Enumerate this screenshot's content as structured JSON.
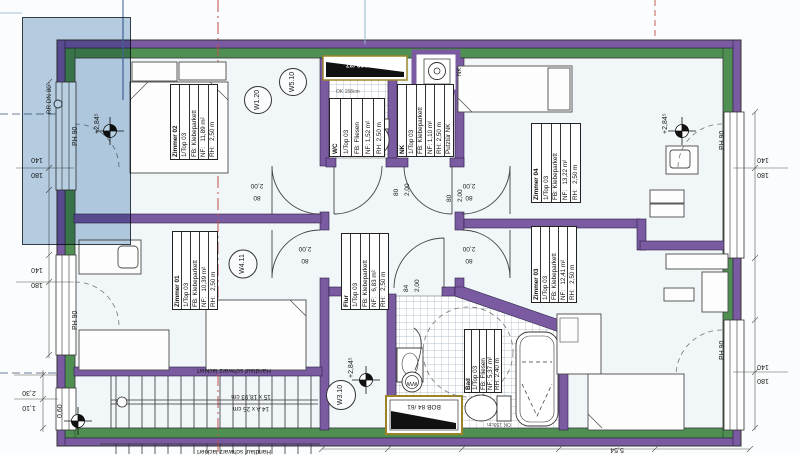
{
  "rooms": {
    "zimmer02": {
      "name": "Zimmer 02",
      "rows": [
        "1/Top 03",
        "FB: Klebeparkett",
        "NF:   11,89 m²",
        "RH:   2,50 m"
      ]
    },
    "zimmer01": {
      "name": "Zimmer 01",
      "rows": [
        "1/Top 03",
        "FB: Klebeparkett",
        "NF:   10,39 m²",
        "RH:   2,50 m"
      ]
    },
    "zimmer04": {
      "name": "Zimmer 04",
      "rows": [
        "1/Top 03",
        "FB: Klebeparkett",
        "NF:   13,22 m²",
        "RH:   2,50 m"
      ]
    },
    "zimmer03": {
      "name": "Zimmer 03",
      "rows": [
        "1/Top 03",
        "FB: Klebeparkett",
        "NF:   12,41 m²",
        "RH:   2,50 m"
      ]
    },
    "flur": {
      "name": "Flur",
      "rows": [
        "1/Top 03",
        "FB: Klebeparkett",
        "NF:   6,83 m²",
        "RH:   2,50 m"
      ]
    },
    "wc": {
      "name": "WC",
      "rows": [
        "1/Top 03",
        "FB: Fliesen",
        "NF: 1,52 m²",
        "RH: 2,50 m"
      ]
    },
    "nk": {
      "name": "NK",
      "rows": [
        "1/Top 03",
        "FB: Klebeparkett",
        "NF: 1,10 m²",
        "RH: 2,50 m",
        "Putztür NK"
      ]
    },
    "bad": {
      "name": "Bad",
      "rows": [
        "1/Top 03",
        "FB: Fliesen",
        "NF: 5,37 m²",
        "RH: 2,40 m"
      ]
    }
  },
  "wall_tags": {
    "w120": "W1.20",
    "w510": "W5.10",
    "w411": "W4.11",
    "w310": "W3.10"
  },
  "levels": {
    "value": "+2,84⁵"
  },
  "heights": {
    "ph90": "PH 90"
  },
  "pipes": {
    "rr": "RR DN 80"
  },
  "shafts": {
    "bob_top": "BOB 139 /37",
    "bob_bottom": "BOB 84 /61",
    "nk_duct": "NK",
    "ww": "WW"
  },
  "doors": {
    "w80": "80",
    "h200": "2,00",
    "w84": "84"
  },
  "dims": {
    "d140": "140",
    "d180": "180",
    "d230": "2,30",
    "d110": "1,10",
    "d060": "0,60",
    "d554": "5,54"
  },
  "stairs": {
    "handrail_note": "Handlauf schwarz lackiert",
    "spec1": "15 x 18,93 cm",
    "spec2": "14 A x 25 cm"
  },
  "notes": {
    "ok158": "OK 158cm"
  }
}
